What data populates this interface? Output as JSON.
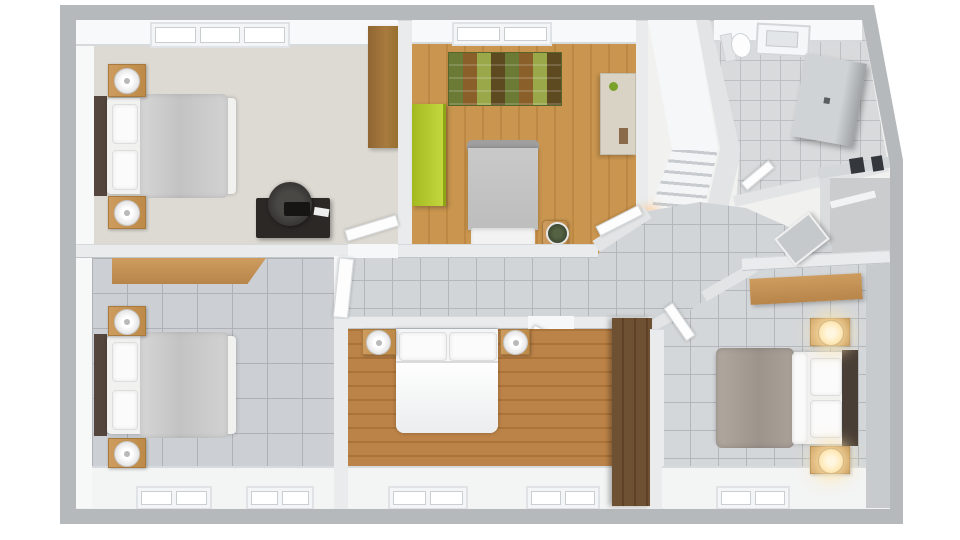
{
  "scene": {
    "kind": "3d-rendered-floor-plan",
    "view": "top-down isometric",
    "visible_text": "none",
    "background_color": "#ffffff"
  },
  "palette": {
    "outer_wall": "#b5b9bc",
    "inner_wall": "#e9ebed",
    "wall_face": "#f7f8f8",
    "carpet_beige": "#dcdad2",
    "wood_floor_light": "#c9954f",
    "wood_floor_warm": "#b98040",
    "tile_gray": "#d2d5d8",
    "tile_line": "#b3b7bb",
    "lime_wardrobe": "#b7cb35",
    "wood_furniture": "#c79757",
    "dark_wood": "#54463c",
    "dark_desk": "#2b2826",
    "blanket_gray": "#c9c9c9",
    "blanket_taupe": "#a89f97",
    "lamp_glow": "#ffe9b8",
    "vent_dark": "#34383c"
  },
  "rooms": [
    {
      "id": "bedroom-top-left",
      "floor": "beige-carpet",
      "furniture": [
        "window",
        "double-bed",
        "gray-blanket",
        "two-pillows",
        "nightstand-with-lamp-upper",
        "nightstand-with-lamp-lower",
        "dark-desk",
        "office-chair",
        "typewriter",
        "wood-wardrobe"
      ]
    },
    {
      "id": "kids-bedroom-top-middle",
      "floor": "light-wood-planks",
      "furniture": [
        "window",
        "patchwork-play-rug",
        "lime-green-wardrobe",
        "beige-cabinet",
        "single-bed-gray",
        "plant-stool"
      ]
    },
    {
      "id": "bathroom-top-right",
      "floor": "small-gray-tiles",
      "walls": "slanted",
      "furniture": [
        "toilet",
        "skylight-window",
        "gray-shower-cabinet"
      ]
    },
    {
      "id": "staircase",
      "floor": "white",
      "furniture": [
        "upper-landing",
        "stair-treads",
        "warm-light"
      ]
    },
    {
      "id": "hallway",
      "floor": "gray-marble-tiles",
      "furniture": [
        "door-to-top-left-bedroom",
        "door-to-kids-bedroom",
        "door-to-bottom-left-bedroom",
        "door-to-bottom-middle-bedroom",
        "door-to-bottom-right-bedroom",
        "door-to-bathroom"
      ]
    },
    {
      "id": "closet-right",
      "floor": "gray",
      "furniture": [
        "two-dark-vents",
        "leaning-board",
        "shelf"
      ]
    },
    {
      "id": "bedroom-bottom-left",
      "floor": "large-gray-tiles",
      "furniture": [
        "wood-shelf-desk",
        "double-bed",
        "gray-blanket",
        "nightstand-with-lamp-upper",
        "nightstand-with-lamp-lower",
        "window-left",
        "window-right"
      ]
    },
    {
      "id": "bedroom-bottom-middle",
      "floor": "warm-wood-planks",
      "furniture": [
        "double-bed-two-pillows",
        "nightstand-with-lamp-left",
        "nightstand-with-lamp-right",
        "dark-wood-wardrobe",
        "window-left",
        "window-right"
      ]
    },
    {
      "id": "bedroom-bottom-right",
      "floor": "gray-tiles",
      "furniture": [
        "wood-shelf",
        "double-bed",
        "taupe-blanket",
        "two-pillows",
        "nightstand-with-glowing-lamp-upper",
        "nightstand-with-glowing-lamp-lower",
        "window"
      ]
    }
  ],
  "counts": {
    "bedrooms": 5,
    "bathrooms": 1,
    "staircases": 1,
    "windows": 8,
    "lamps": 8
  }
}
